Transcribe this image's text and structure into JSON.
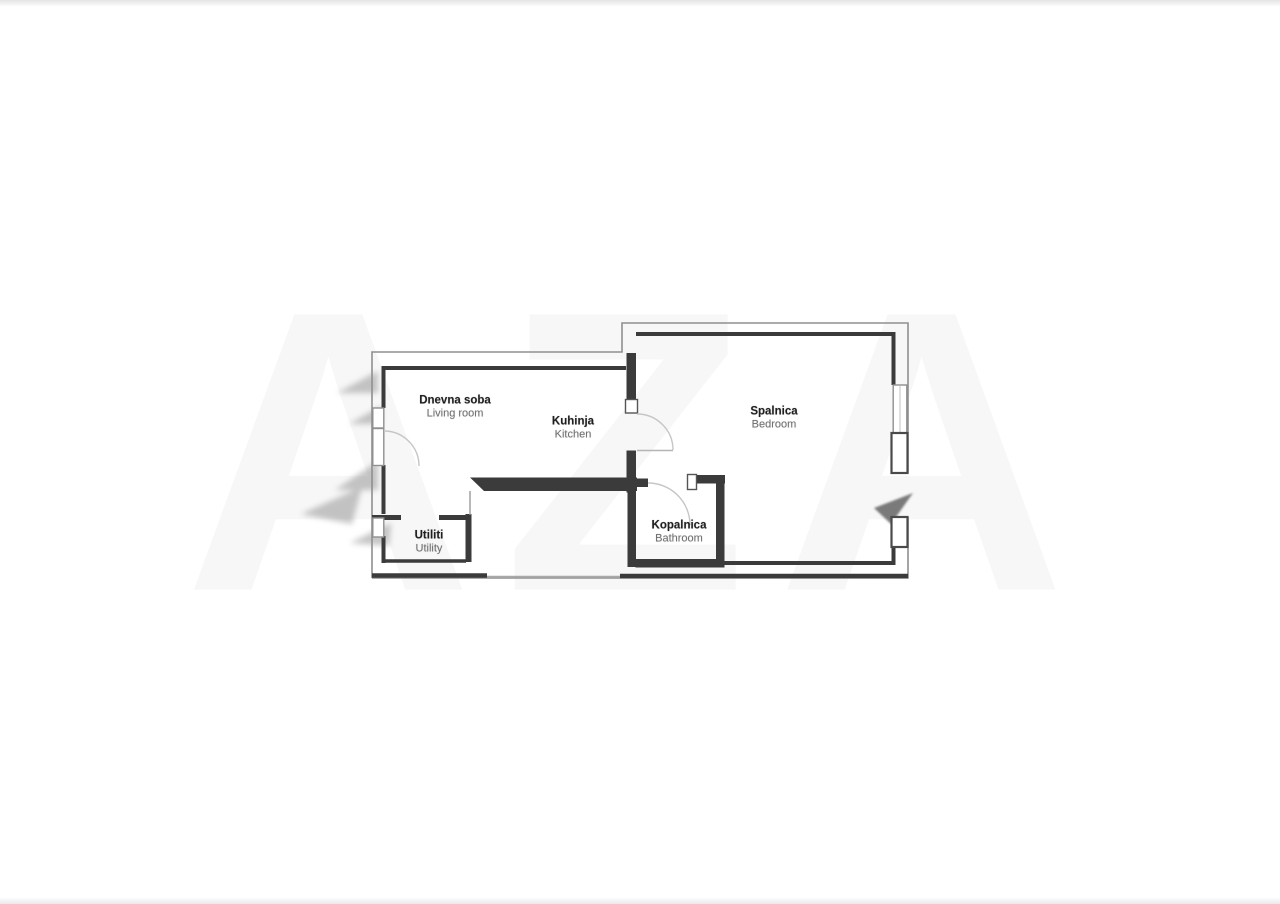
{
  "page": {
    "background": "#ffffff",
    "top_band_color": "#e4e4e6",
    "bottom_band_color": "#e9e9eb"
  },
  "floorplan": {
    "watermark": {
      "text": "AZA",
      "color": "#000000",
      "opacity": 0.028
    },
    "colors": {
      "wall_thick": "#3b3b3b",
      "wall_thin": "#8f8f8f",
      "door_arc": "#c6c6c6",
      "label_primary": "#1f1f1f",
      "label_secondary": "#6f6f6f",
      "smudge": "#8e8e8e",
      "entrance_arrow": "#5f5f5f"
    },
    "rooms": [
      {
        "id": "living-room",
        "name_sl": "Dnevna soba",
        "name_en": "Living room",
        "label_x": 455,
        "label_y": 407
      },
      {
        "id": "kitchen",
        "name_sl": "Kuhinja",
        "name_en": "Kitchen",
        "label_x": 573,
        "label_y": 428
      },
      {
        "id": "bedroom",
        "name_sl": "Spalnica",
        "name_en": "Bedroom",
        "label_x": 774,
        "label_y": 418
      },
      {
        "id": "bathroom",
        "name_sl": "Kopalnica",
        "name_en": "Bathroom",
        "label_x": 679,
        "label_y": 532
      },
      {
        "id": "utility",
        "name_sl": "Utiliti",
        "name_en": "Utility",
        "label_x": 429,
        "label_y": 542
      }
    ]
  }
}
